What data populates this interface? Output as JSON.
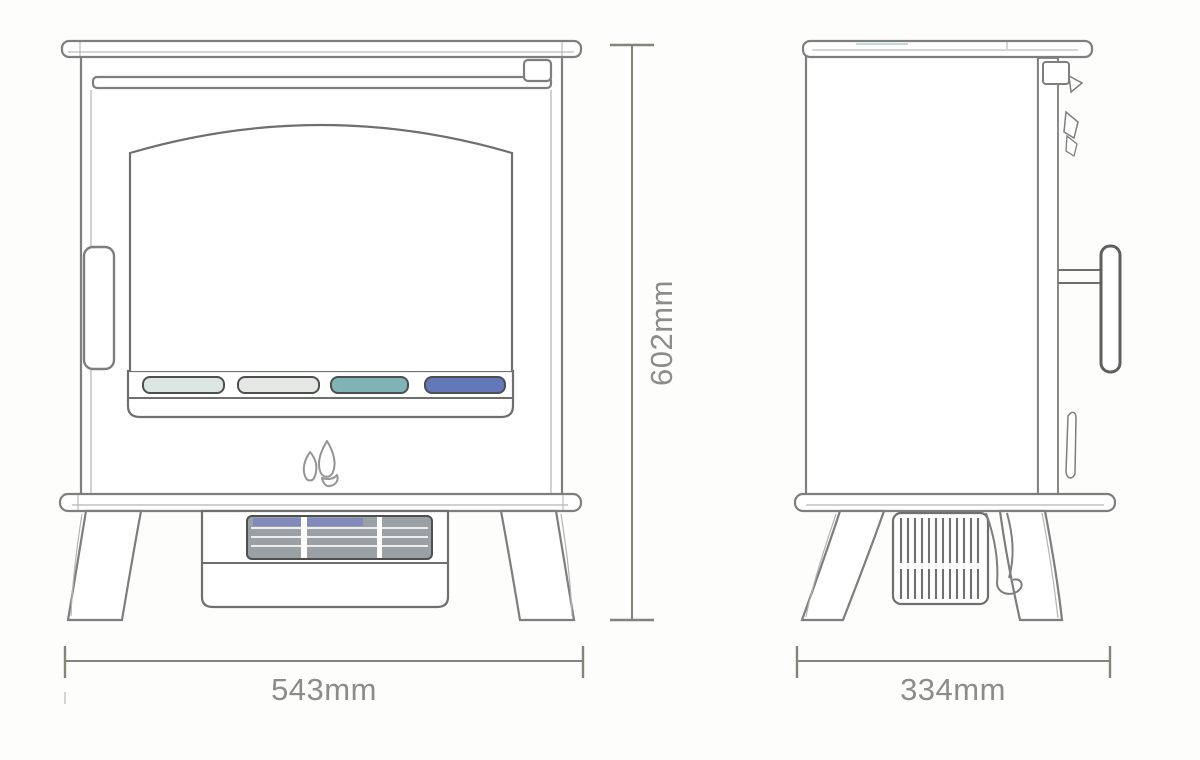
{
  "diagram": {
    "type": "technical-dimension-drawing",
    "subject": "electric stove heater, front and side elevations",
    "views": [
      {
        "id": "front-view",
        "dimension_labels": [
          "602mm",
          "543mm"
        ]
      },
      {
        "id": "side-view",
        "dimension_labels": [
          "334mm"
        ]
      }
    ]
  },
  "dimensions": {
    "height": {
      "label": "602mm",
      "value": 602,
      "unit": "mm"
    },
    "width": {
      "label": "543mm",
      "value": 543,
      "unit": "mm"
    },
    "depth": {
      "label": "334mm",
      "value": 334,
      "unit": "mm"
    }
  },
  "icons": {
    "flame_logo": "flame-logo-icon"
  },
  "colors": {
    "line": "#7e7e7e",
    "dim_text": "#8c8c8c",
    "slot_1": "#dce6e2",
    "slot_2": "#e5e7e4",
    "slot_3": "#7fb3b6",
    "slot_4": "#6278b9",
    "grille_fill": "#9aa0a4",
    "grille_tint": "#7d86c0"
  }
}
